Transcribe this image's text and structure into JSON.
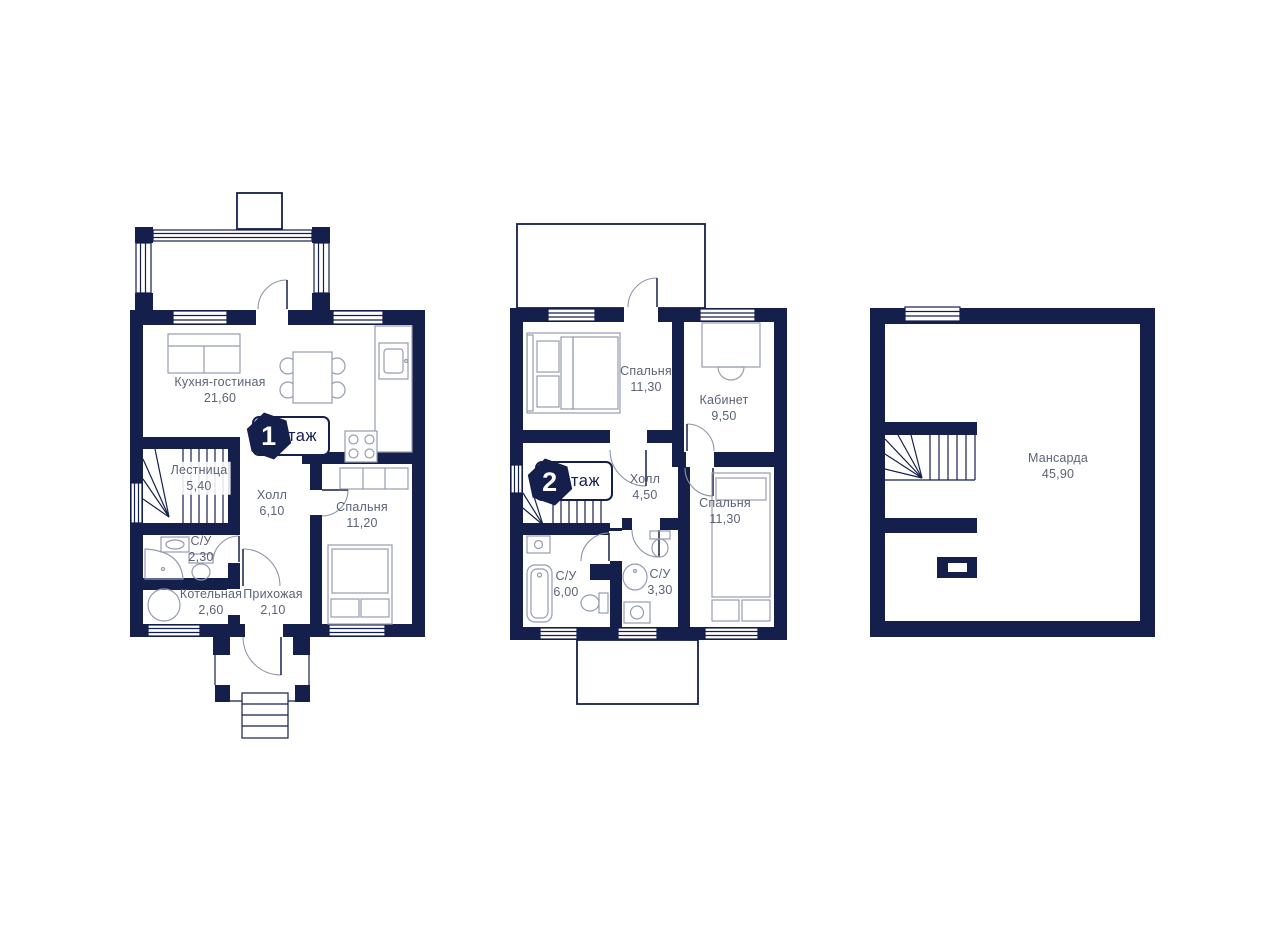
{
  "title": "Коттедж — поэтажные планы",
  "colors": {
    "wall": "#151f4c",
    "furniture_line": "#959cb0",
    "label_text": "#5b6377",
    "background": "#ffffff"
  },
  "plans": {
    "floor1": {
      "badge": {
        "number": "1",
        "label": "Этаж"
      },
      "rooms": [
        {
          "name": "Кухня-гостиная",
          "area": "21,60"
        },
        {
          "name": "Лестница",
          "area": "5,40"
        },
        {
          "name": "Холл",
          "area": "6,10"
        },
        {
          "name": "Спальня",
          "area": "11,20"
        },
        {
          "name": "С/У",
          "area": "2,30"
        },
        {
          "name": "Котельная",
          "area": "2,60"
        },
        {
          "name": "Прихожая",
          "area": "2,10"
        }
      ]
    },
    "floor2": {
      "badge": {
        "number": "2",
        "label": "Этаж"
      },
      "rooms": [
        {
          "name": "Спальня",
          "area": "11,30"
        },
        {
          "name": "Кабинет",
          "area": "9,50"
        },
        {
          "name": "Холл",
          "area": "4,50"
        },
        {
          "name": "Спальня",
          "area": "11,30"
        },
        {
          "name": "С/У",
          "area": "6,00"
        },
        {
          "name": "С/У",
          "area": "3,30"
        }
      ]
    },
    "attic": {
      "rooms": [
        {
          "name": "Мансарда",
          "area": "45,90"
        }
      ]
    }
  }
}
